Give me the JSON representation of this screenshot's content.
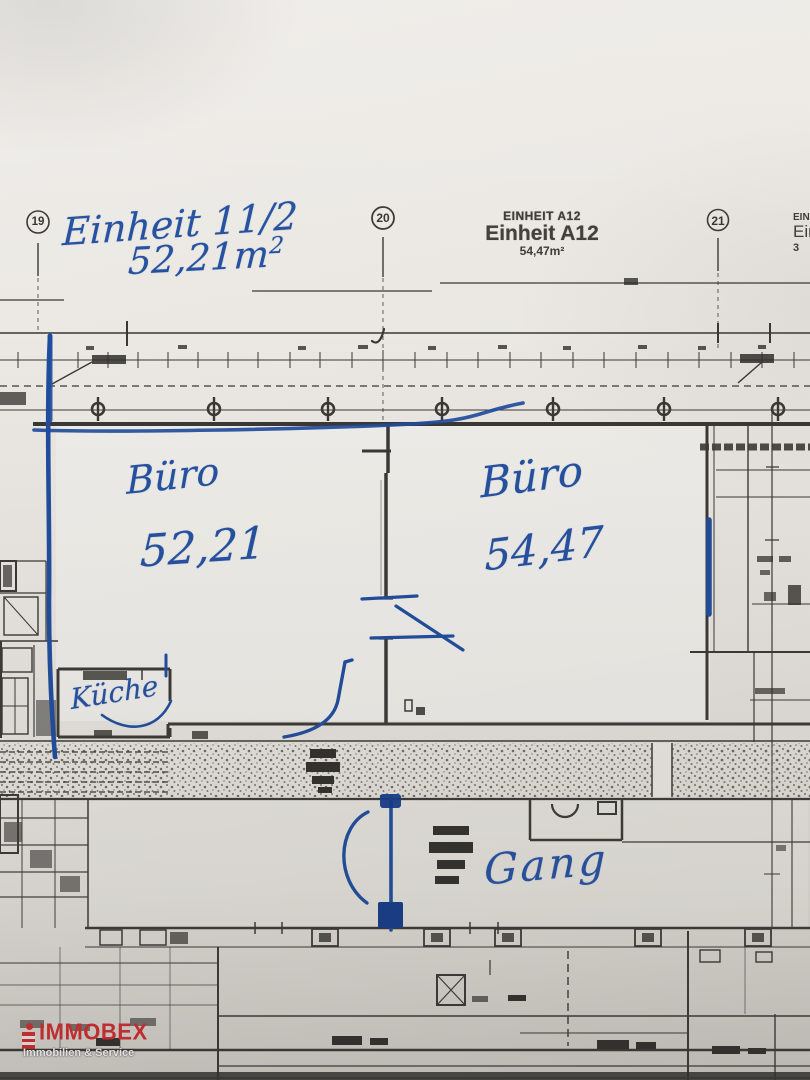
{
  "annotations": {
    "unit_label": "Einheit 11/2",
    "unit_area_value": "52,21m",
    "unit_area_sup": "2",
    "room_left_name": "Büro",
    "room_left_area": "52,21",
    "room_right_name": "Büro",
    "room_right_area": "54,47",
    "kitchen_label": "Küche",
    "corridor_label": "Gang"
  },
  "printed": {
    "grid_markers": [
      "19",
      "20",
      "21"
    ],
    "unit_caps": "EINHEIT A12",
    "unit_name": "Einheit A12",
    "unit_area": "54,47m²",
    "edge_partial_caps": "EINH",
    "edge_partial_name": "Ein",
    "edge_partial_area": "3"
  },
  "logo": {
    "brand": "IMMOBEX",
    "tagline": "Immobilien & Service",
    "brand_color": "#d32a2f"
  },
  "colors": {
    "ink_blue": "#1f4c9c",
    "plan_line": "#3a3834",
    "paper": "#eae7e2"
  }
}
